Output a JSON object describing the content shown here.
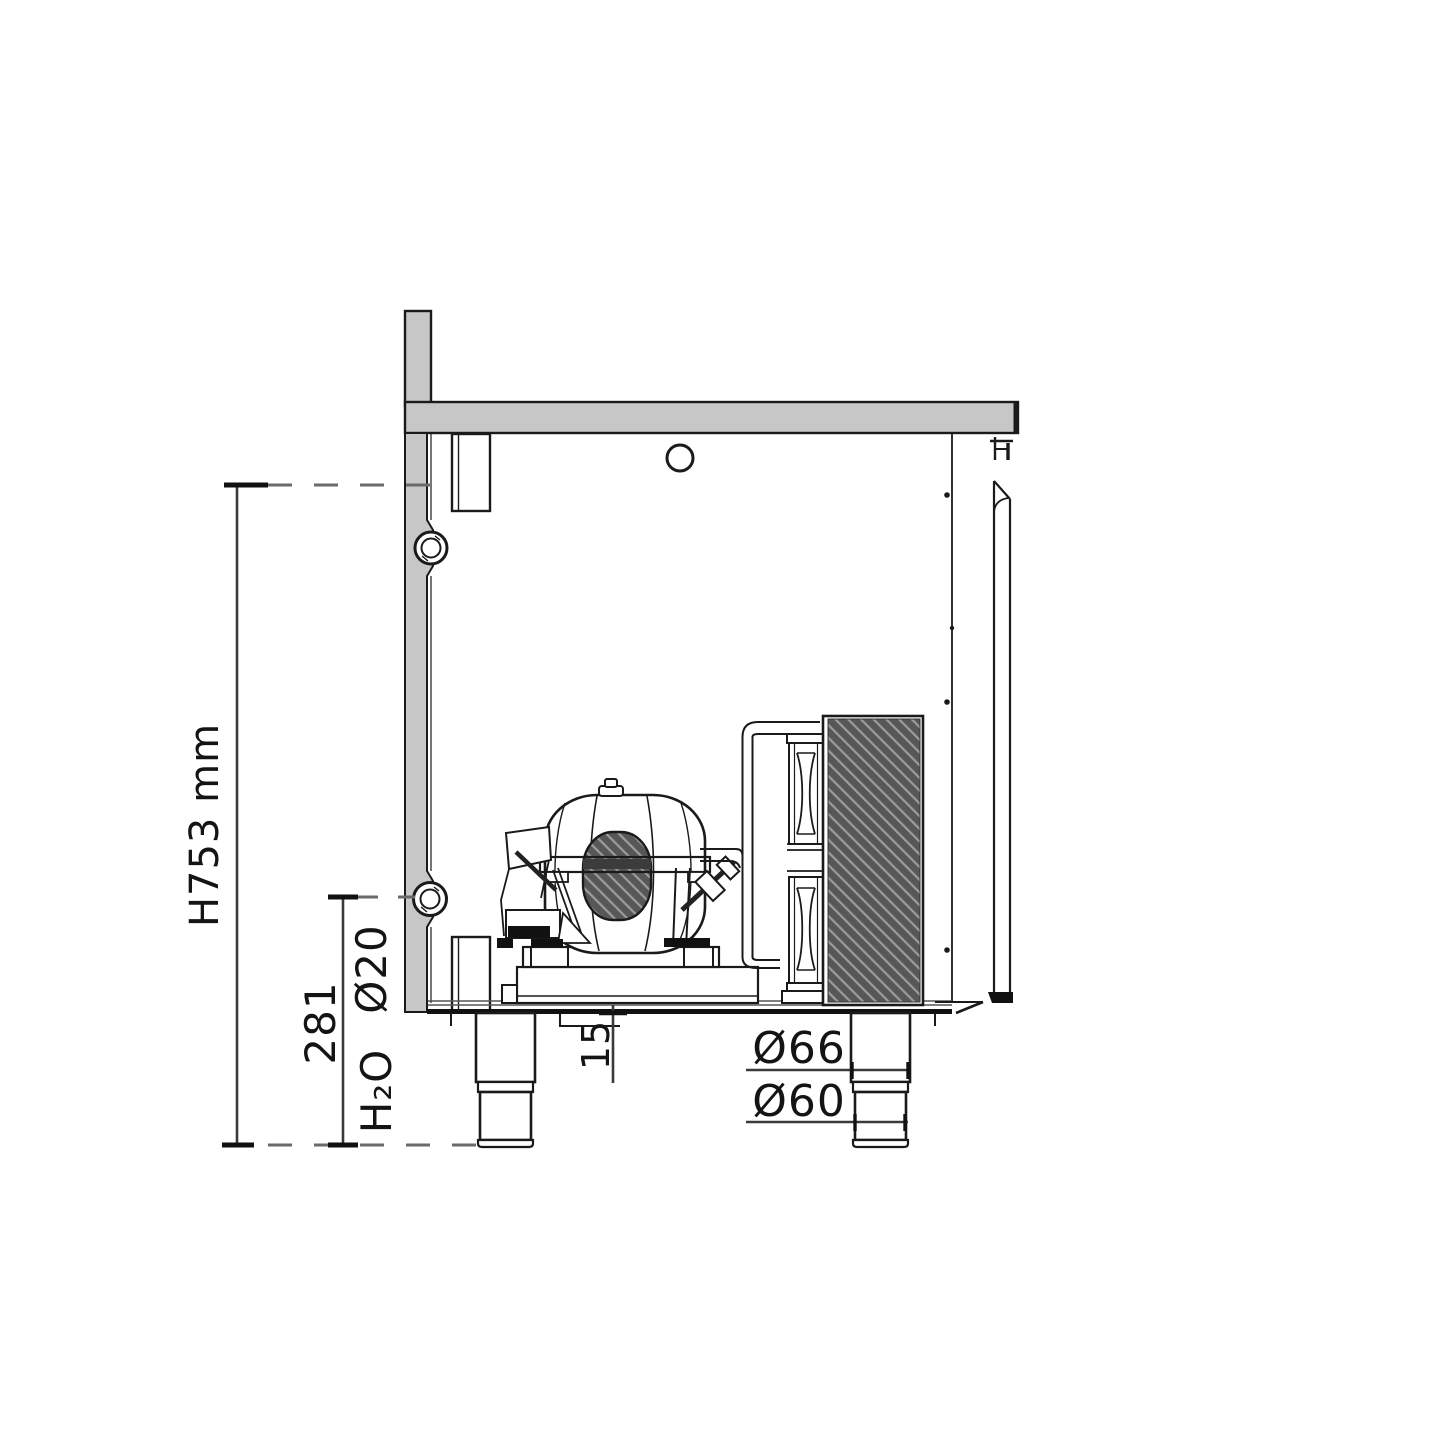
{
  "drawing": {
    "type": "refrigerated-counter-side-section",
    "labels": {
      "overall_height": "H753 mm",
      "drain_height": "281",
      "drain_diameter": "Ø20",
      "drain_medium": "H₂O",
      "base_offset": "15",
      "leg_upper_diameter": "Ø66",
      "leg_foot_diameter": "Ø60"
    },
    "colors": {
      "line": "#1a1a1a",
      "dimension_line": "#3a3a3a",
      "dash_line": "#6a6a6a",
      "panel_gray": "#c7c7c7",
      "hatch_dark": "#575757",
      "hatch_light": "#9c9c9c",
      "background": "#ffffff"
    }
  }
}
